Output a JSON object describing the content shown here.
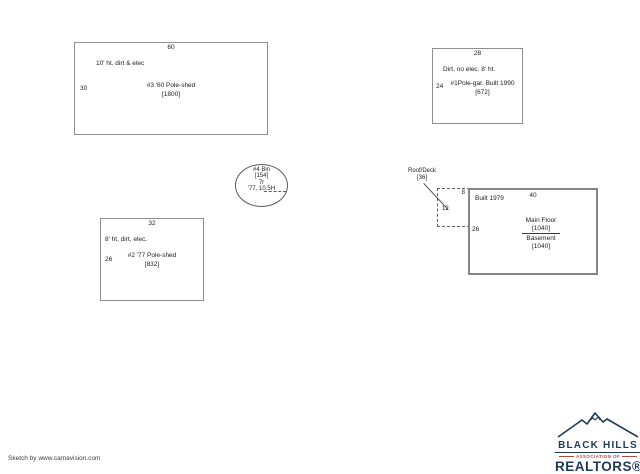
{
  "colors": {
    "border_gray": "#8e8e8e",
    "line_dark": "#4a4a4a",
    "logo_navy": "#1e3a5a",
    "logo_red": "#b44a3c"
  },
  "buildings": [
    {
      "id": "pole-shed-1960",
      "top_dim": "60",
      "left_dim": "30",
      "note": "10' ht. dirt & elec",
      "name": "#3 '60 Pole-shed",
      "area": "[1800]"
    },
    {
      "id": "pole-garage-1990",
      "top_dim": "28",
      "left_dim": "24",
      "note": "Dirt, no elec. 8' ht.",
      "name": "#1Pole-gar. Built 1990",
      "area": "[672]"
    },
    {
      "id": "pole-shed-1977",
      "top_dim": "32",
      "left_dim": "26",
      "note": "8' ht, dirt, elec.",
      "name": "#2 '77 Pole-shed",
      "area": "[832]"
    },
    {
      "id": "house-1979",
      "top_dim": "40",
      "left_dim": "26",
      "note": "Built 1979",
      "main_floor_label": "Main Floor",
      "main_floor_area": "[1040]",
      "basement_label": "Basement",
      "basement_area": "[1040]"
    }
  ],
  "bin": {
    "name": "#4 Bin",
    "area": "[154]",
    "radius": "7r",
    "note": "'77, 10.5H"
  },
  "roof_deck": {
    "label": "Roof/Deck",
    "area": "[36]",
    "top_dim": "8",
    "left_dim": "12"
  },
  "footer": {
    "credit": "Sketch by www.camavision.com"
  },
  "logo": {
    "line1": "BLACK HILLS",
    "line2": "ASSOCIATION OF",
    "line3": "REALTORS®"
  }
}
